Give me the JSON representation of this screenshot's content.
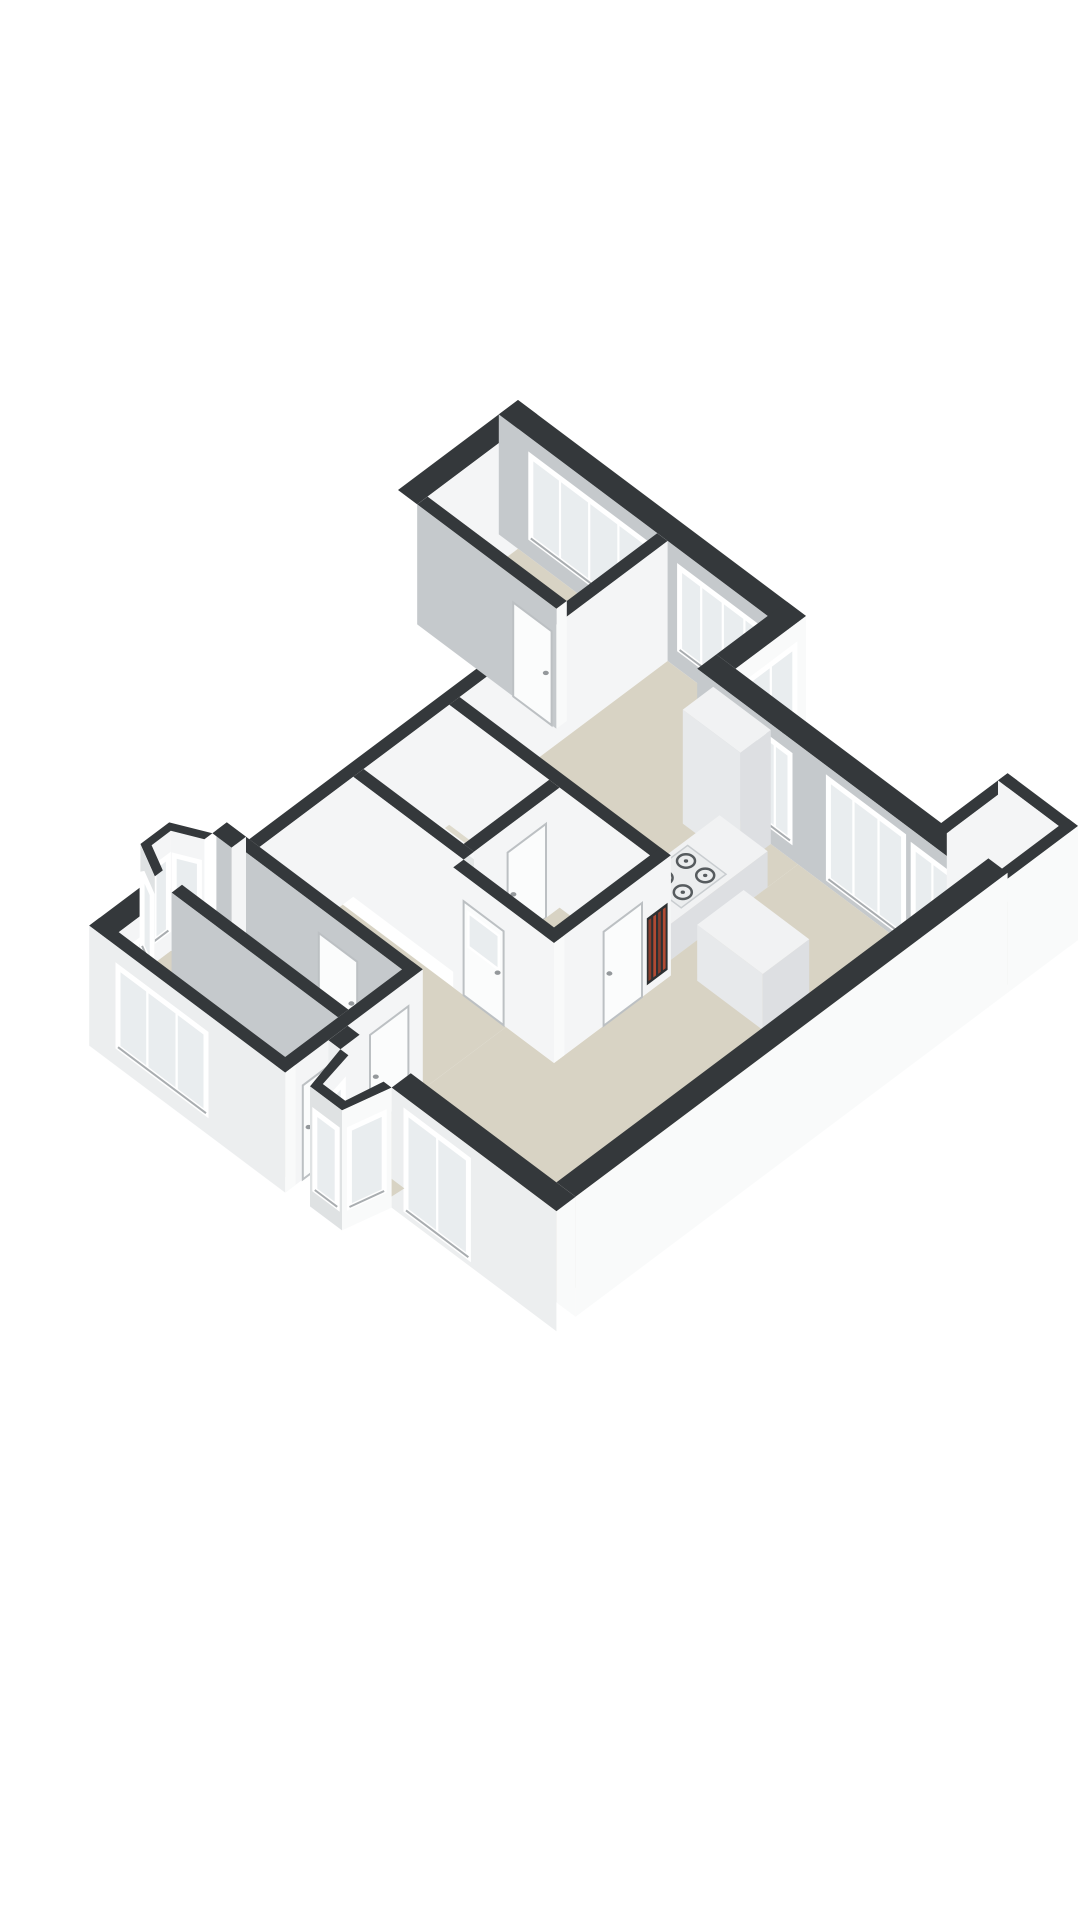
{
  "palette": {
    "bg": "#ffffff",
    "top": "#34383b",
    "inS": "#c5c9cc",
    "inE": "#f4f5f6",
    "exS": "#eceeef",
    "exE": "#f9fafa",
    "bayOut": "#dfe2e3",
    "floor": "#d8d3c4",
    "floorB": "#dedacc",
    "balcF": "#d3d4d1",
    "glass": "#e9edef",
    "frame": "#ffffff",
    "sill": "#a9adb0",
    "door": "#fbfcfc",
    "doorE": "#bcc0c3",
    "handle": "#94989b",
    "boxT": "#f1f2f3",
    "boxS": "#e7e9eb",
    "boxE": "#dddfe2",
    "tubT": "#f7f8f9",
    "tubIn": "#e4e7e7",
    "hobPlate": "#ebedee",
    "hobEdge": "#c9cdd0",
    "burner": "#565b5e",
    "radBg": "#2d3032",
    "radA": "#8a3c2b",
    "radB": "#b14a33"
  },
  "projection": {
    "origin_x": 518,
    "origin_y": 400,
    "axis_x": 0.8,
    "axis_y": 0.6,
    "wall_height": 120
  },
  "scene": [
    {
      "n": "bedroomA-west-wall",
      "t": "wallX",
      "x": 0,
      "th": 24,
      "y1": 0,
      "y2": 150,
      "f": "inE"
    },
    {
      "n": "north-facade-wall",
      "t": "wallY",
      "x1": 0,
      "x2": 360,
      "y": 0,
      "th": 24,
      "f": "inS"
    },
    {
      "n": "bedroomA-window",
      "t": "panS",
      "y": 24,
      "a": 40,
      "b": 186,
      "z1": -100,
      "z2": -18,
      "k": "win",
      "m": 4
    },
    {
      "n": "kitchen-nook-window",
      "t": "panS",
      "y": 24,
      "a": 226,
      "b": 334,
      "z1": -100,
      "z2": -18,
      "k": "win",
      "m": 4
    },
    {
      "n": "bedroomA-floor",
      "t": "floor",
      "z": -120,
      "pts": [
        [
          24,
          24
        ],
        [
          198,
          24
        ],
        [
          198,
          137
        ],
        [
          24,
          137
        ]
      ],
      "f": "floor"
    },
    {
      "n": "bedroomA-east-wall",
      "t": "wallX",
      "x": 198,
      "th": 13,
      "y1": 24,
      "y2": 534,
      "f": "inE"
    },
    {
      "n": "bedroomA-south-wall",
      "t": "wallY",
      "x1": 24,
      "x2": 198,
      "y": 137,
      "th": 13,
      "f": "inS",
      "capE": 1
    },
    {
      "n": "bedroomA-door",
      "t": "panS",
      "y": 150,
      "a": 144,
      "b": 192,
      "z1": -120,
      "z2": -26,
      "k": "door"
    },
    {
      "n": "step-wall",
      "t": "wallX",
      "x": 336,
      "th": 24,
      "y1": 0,
      "y2": 88,
      "f": "exE"
    },
    {
      "n": "step-window",
      "t": "panE",
      "x": 360,
      "a": 14,
      "b": 74,
      "z1": -100,
      "z2": -22,
      "k": "win",
      "m": 2
    },
    {
      "n": "kitchen-floor",
      "t": "floor",
      "z": -120,
      "pts": [
        [
          211,
          24
        ],
        [
          336,
          24
        ],
        [
          336,
          112
        ],
        [
          462,
          112
        ],
        [
          462,
          284
        ],
        [
          211,
          284
        ]
      ],
      "f": "floor"
    },
    {
      "n": "north-facade-living-wall",
      "t": "wallY",
      "x1": 336,
      "x2": 700,
      "y": 88,
      "th": 24,
      "f": "inS"
    },
    {
      "n": "dining-window-west",
      "t": "panS",
      "y": 112,
      "a": 414,
      "b": 452,
      "z1": -102,
      "z2": -16,
      "k": "win",
      "m": 2
    },
    {
      "n": "french-doors",
      "t": "panS",
      "y": 112,
      "a": 500,
      "b": 594,
      "z1": -112,
      "z2": -12,
      "k": "win",
      "m": 3
    },
    {
      "n": "dining-window-east",
      "t": "panS",
      "y": 112,
      "a": 606,
      "b": 654,
      "z1": -102,
      "z2": -16,
      "k": "win",
      "m": 2
    },
    {
      "n": "balcony-floor",
      "t": "floor",
      "z": -112,
      "pts": [
        [
          612,
          6
        ],
        [
          700,
          6
        ],
        [
          700,
          88
        ],
        [
          612,
          88
        ]
      ],
      "f": "balcF"
    },
    {
      "n": "balcony-parapet-west",
      "t": "wallX",
      "x": 612,
      "th": 12,
      "y1": 0,
      "y2": 88,
      "f": "inE",
      "top": -6
    },
    {
      "n": "balcony-parapet-north",
      "t": "wallY",
      "x1": 612,
      "x2": 700,
      "y": 0,
      "th": 12,
      "f": "inE",
      "top": -6,
      "capE": 1
    },
    {
      "n": "balcony-parapet-east",
      "t": "wallX",
      "x": 688,
      "th": 12,
      "y1": 0,
      "y2": 88,
      "f": "exE",
      "top": -6
    },
    {
      "n": "kitchen-tall-cabinet",
      "t": "box",
      "x1": 356,
      "y1": 112,
      "x2": 428,
      "y2": 150,
      "z1": -120,
      "z2": -6
    },
    {
      "n": "living-dining-floor",
      "t": "floor",
      "z": -120,
      "pts": [
        [
          462,
          112
        ],
        [
          676,
          112
        ],
        [
          676,
          628
        ],
        [
          415,
          628
        ],
        [
          415,
          430
        ],
        [
          475,
          430
        ],
        [
          475,
          284
        ],
        [
          462,
          284
        ]
      ],
      "f": "floor"
    },
    {
      "n": "living-floor-west",
      "t": "floor",
      "z": -120,
      "pts": [
        [
          211,
          430
        ],
        [
          415,
          430
        ],
        [
          415,
          534
        ],
        [
          211,
          534
        ]
      ],
      "f": "floor"
    },
    {
      "n": "kitchen-counter",
      "t": "box",
      "x1": 402,
      "y1": 150,
      "x2": 462,
      "y2": 284,
      "z1": -120,
      "z2": -84
    },
    {
      "n": "gas-hob",
      "t": "burners",
      "x1": 408,
      "y1": 196,
      "x2": 456,
      "y2": 252,
      "z": -83
    },
    {
      "n": "kitchen-south-wall",
      "t": "wallY",
      "x1": 211,
      "x2": 475,
      "y": 284,
      "th": 13,
      "f": "inE",
      "capE": 1
    },
    {
      "n": "bathroom-floor",
      "t": "floor",
      "z": -120,
      "pts": [
        [
          211,
          297
        ],
        [
          336,
          297
        ],
        [
          336,
          404
        ],
        [
          211,
          404
        ]
      ],
      "f": "floorB"
    },
    {
      "n": "bathtub",
      "t": "tub",
      "x1": 222,
      "y1": 344,
      "x2": 316,
      "y2": 400,
      "z1": -120,
      "z2": -70
    },
    {
      "n": "bathroom-east-wall",
      "t": "wallX",
      "x": 336,
      "th": 13,
      "y1": 297,
      "y2": 404,
      "f": "inE"
    },
    {
      "n": "bathroom-door",
      "t": "panE",
      "x": 349,
      "a": 314,
      "b": 362,
      "z1": -120,
      "z2": -26,
      "k": "door"
    },
    {
      "n": "bathroom-south-wall",
      "t": "wallY",
      "x1": 211,
      "x2": 349,
      "y": 404,
      "th": 13,
      "f": "inE"
    },
    {
      "n": "hall-floor",
      "t": "floor",
      "z": -120,
      "pts": [
        [
          349,
          297
        ],
        [
          462,
          297
        ],
        [
          462,
          417
        ],
        [
          349,
          417
        ]
      ],
      "f": "floor"
    },
    {
      "n": "dining-west-wall",
      "t": "wallX",
      "x": 462,
      "th": 13,
      "y1": 284,
      "y2": 430,
      "f": "inE"
    },
    {
      "n": "radiator",
      "t": "rad",
      "x": 475,
      "a": 288,
      "b": 314,
      "z1": -112,
      "z2": -45
    },
    {
      "n": "dining-door",
      "t": "panE",
      "x": 475,
      "a": 320,
      "b": 368,
      "z1": -120,
      "z2": -26,
      "k": "door"
    },
    {
      "n": "dining-island",
      "t": "box",
      "x1": 496,
      "y1": 214,
      "x2": 578,
      "y2": 272,
      "z1": -120,
      "z2": -64
    },
    {
      "n": "hall-south-wall",
      "t": "wallY",
      "x1": 349,
      "x2": 475,
      "y": 417,
      "th": 13,
      "f": "inE",
      "capE": 1
    },
    {
      "n": "hall-glazed-door",
      "t": "panS",
      "y": 430,
      "a": 362,
      "b": 412,
      "z1": -120,
      "z2": -26,
      "k": "glz"
    },
    {
      "n": "wing-north-wall",
      "t": "wallY",
      "x1": 170,
      "x2": 415,
      "y": 534,
      "th": 13,
      "f": "inS"
    },
    {
      "n": "wing-north-door",
      "t": "panS",
      "y": 547,
      "a": 298,
      "b": 346,
      "z1": -120,
      "z2": -26,
      "k": "door"
    },
    {
      "n": "wing-west-wall-north",
      "t": "wallX",
      "x": 170,
      "th": 24,
      "y1": 534,
      "y2": 552,
      "f": "inE"
    },
    {
      "n": "wing-west-wall-south",
      "t": "wallX",
      "x": 170,
      "th": 24,
      "y1": 624,
      "y2": 706,
      "f": "inE"
    },
    {
      "n": "wing-west-window",
      "t": "panE",
      "x": 194,
      "a": 648,
      "b": 690,
      "z1": -100,
      "z2": -24,
      "k": "win",
      "m": 2
    },
    {
      "n": "bedroomB-floor",
      "t": "floor",
      "z": -120,
      "pts": [
        [
          194,
          547
        ],
        [
          402,
          547
        ],
        [
          402,
          614
        ],
        [
          194,
          614
        ]
      ],
      "f": "floor"
    },
    {
      "n": "bay1-floor",
      "t": "floor",
      "z": -120,
      "pts": [
        [
          194,
          556
        ],
        [
          142,
          574
        ],
        [
          142,
          602
        ],
        [
          194,
          620
        ]
      ],
      "f": "floor"
    },
    {
      "n": "bay1-inner-nw-face",
      "t": "poly",
      "f": "inE",
      "pts": [
        [
          170,
          562,
          0
        ],
        [
          142,
          576,
          0
        ],
        [
          142,
          576,
          -120
        ],
        [
          170,
          562,
          -120
        ]
      ]
    },
    {
      "n": "bay1-window-nw",
      "t": "panP",
      "p1": [
        165.8,
        564.1
      ],
      "p2": [
        144.8,
        574.6
      ],
      "z1": -98,
      "z2": -24,
      "k": "win",
      "m": 1
    },
    {
      "n": "bay1-inner-west-face",
      "t": "poly",
      "f": "inE",
      "pts": [
        [
          142,
          576,
          0
        ],
        [
          142,
          600,
          0
        ],
        [
          142,
          600,
          -120
        ],
        [
          142,
          576,
          -120
        ]
      ]
    },
    {
      "n": "bay1-window-west",
      "t": "panP",
      "p1": [
        142,
        579
      ],
      "p2": [
        142,
        597
      ],
      "z1": -98,
      "z2": -24,
      "k": "win",
      "m": 1
    },
    {
      "n": "bay1-top-band",
      "t": "poly",
      "f": "top",
      "pts": [
        [
          170,
          552,
          0
        ],
        [
          134,
          570,
          0
        ],
        [
          134,
          606,
          0
        ],
        [
          170,
          624,
          0
        ],
        [
          170,
          614,
          0
        ],
        [
          142,
          600,
          0
        ],
        [
          142,
          576,
          0
        ],
        [
          170,
          562,
          0
        ]
      ]
    },
    {
      "n": "bay1-outer-south-face",
      "t": "poly",
      "f": "bayOut",
      "pts": [
        [
          134,
          606,
          0
        ],
        [
          170,
          624,
          0
        ],
        [
          170,
          624,
          -120
        ],
        [
          134,
          606,
          -120
        ]
      ]
    },
    {
      "n": "bay1-window-south",
      "t": "panP",
      "p1": [
        138.3,
        608.2
      ],
      "p2": [
        163.5,
        620.8
      ],
      "z1": -98,
      "z2": -24,
      "k": "win",
      "m": 1
    },
    {
      "n": "bedroomBC-divider-wall",
      "t": "wallY",
      "x1": 194,
      "x2": 402,
      "y": 614,
      "th": 13,
      "f": "inS"
    },
    {
      "n": "bedroomC-floor",
      "t": "floor",
      "z": -120,
      "pts": [
        [
          194,
          627
        ],
        [
          402,
          627
        ],
        [
          402,
          693
        ],
        [
          194,
          693
        ]
      ],
      "f": "floor"
    },
    {
      "n": "wing-east-wall",
      "t": "wallX",
      "x": 402,
      "th": 13,
      "y1": 534,
      "y2": 706,
      "f": "inE"
    },
    {
      "n": "bedroomB-door",
      "t": "panE",
      "x": 415,
      "a": 552,
      "b": 600,
      "z1": -120,
      "z2": -26,
      "k": "door"
    },
    {
      "n": "bedroomC-door",
      "t": "panE",
      "x": 415,
      "a": 636,
      "b": 684,
      "z1": -120,
      "z2": -26,
      "k": "door"
    },
    {
      "n": "wing-south-wall",
      "t": "wallY",
      "x1": 170,
      "x2": 415,
      "y": 693,
      "th": 13,
      "f": "exS",
      "capE": 1
    },
    {
      "n": "wing-south-windows",
      "t": "panS",
      "y": 706,
      "a": 206,
      "b": 316,
      "z1": -100,
      "z2": -20,
      "k": "win",
      "m": 3
    },
    {
      "n": "east-exterior-wall",
      "t": "wallX",
      "x": 676,
      "th": 24,
      "y1": 88,
      "y2": 628,
      "f": "exE",
      "capS": 1
    },
    {
      "n": "living-south-wall-west",
      "t": "wallY",
      "x1": 415,
      "x2": 430,
      "y": 628,
      "th": 24,
      "f": "exS"
    },
    {
      "n": "living-south-wall-east",
      "t": "wallY",
      "x1": 494,
      "x2": 700,
      "y": 628,
      "th": 24,
      "f": "exS"
    },
    {
      "n": "living-south-window",
      "t": "panS",
      "y": 652,
      "a": 512,
      "b": 590,
      "z1": -112,
      "z2": -14,
      "k": "win",
      "m": 2
    },
    {
      "n": "bay2-floor",
      "t": "floor",
      "z": -120,
      "pts": [
        [
          438,
          628
        ],
        [
          486,
          628
        ],
        [
          484,
          652
        ],
        [
          476,
          692
        ],
        [
          448,
          692
        ],
        [
          440,
          652
        ]
      ],
      "f": "floor"
    },
    {
      "n": "bay2-inner-west-face",
      "t": "poly",
      "f": "inE",
      "pts": [
        [
          440,
          652,
          0
        ],
        [
          448,
          692,
          0
        ],
        [
          448,
          692,
          -120
        ],
        [
          440,
          652,
          -120
        ]
      ]
    },
    {
      "n": "bay2-window-west",
      "t": "panP",
      "p1": [
        441.6,
        660
      ],
      "p2": [
        447.2,
        688
      ],
      "z1": -100,
      "z2": -22,
      "k": "win",
      "m": 1
    },
    {
      "n": "bay2-top-band",
      "t": "poly",
      "f": "top",
      "pts": [
        [
          430,
          652,
          0
        ],
        [
          442,
          702,
          0
        ],
        [
          482,
          702,
          0
        ],
        [
          494,
          652,
          0
        ],
        [
          484,
          652,
          0
        ],
        [
          476,
          692,
          0
        ],
        [
          448,
          692,
          0
        ],
        [
          440,
          652,
          0
        ]
      ]
    },
    {
      "n": "bay2-front-face",
      "t": "poly",
      "f": "bayOut",
      "pts": [
        [
          442,
          702,
          0
        ],
        [
          482,
          702,
          0
        ],
        [
          482,
          702,
          -120
        ],
        [
          442,
          702,
          -120
        ]
      ]
    },
    {
      "n": "bay2-window-front",
      "t": "panP",
      "p1": [
        448,
        702
      ],
      "p2": [
        476,
        702
      ],
      "z1": -100,
      "z2": -22,
      "k": "win",
      "m": 1
    },
    {
      "n": "bay2-east-face",
      "t": "poly",
      "f": "exE",
      "pts": [
        [
          482,
          702,
          0
        ],
        [
          494,
          652,
          0
        ],
        [
          494,
          652,
          -120
        ],
        [
          482,
          702,
          -120
        ]
      ]
    },
    {
      "n": "bay2-window-east",
      "t": "panP",
      "p1": [
        483.8,
        694.5
      ],
      "p2": [
        492.2,
        659.5
      ],
      "z1": -100,
      "z2": -22,
      "k": "win",
      "m": 1
    }
  ]
}
